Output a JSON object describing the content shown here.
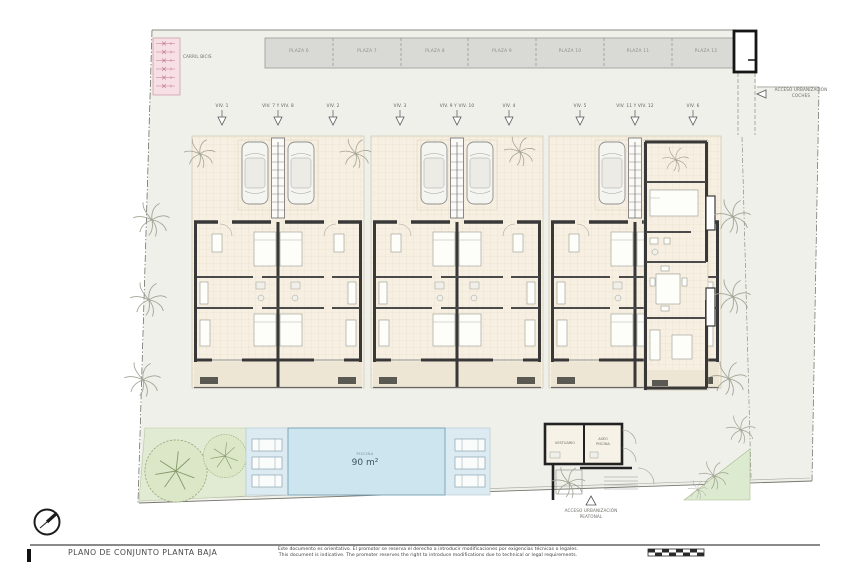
{
  "title_block": {
    "title": "PLANO DE CONJUNTO PLANTA BAJA",
    "disclaimer_es": "Este documento es orientativo. El promotor se reserva el derecho a introducir modificaciones por exigencias técnicas o legales.",
    "disclaimer_en": "This document is indicative. The promoter reserves the right to introduce modifications due to technical or legal requirements."
  },
  "parking": {
    "stalls": [
      "PLAZA 6",
      "PLAZA 7",
      "PLAZA 8",
      "PLAZA 9",
      "PLAZA 10",
      "PLAZA 11",
      "PLAZA 12"
    ]
  },
  "units": {
    "labels": [
      "VIV. 1",
      "VIV. 7 Y VIV. 8",
      "VIV. 2",
      "VIV. 3",
      "VIV. 9 Y VIV. 10",
      "VIV. 4",
      "VIV. 5",
      "VIV. 11 Y VIV. 12",
      "VIV. 6"
    ]
  },
  "site": {
    "bike_lane_label": "CARRIL BICIS",
    "access_cars_line1": "ACCESO URBANIZACIÓN",
    "access_cars_line2": "COCHES",
    "access_ped_line1": "ACCESO URBANIZACIÓN",
    "access_ped_line2": "PEATONAL",
    "pool_label": "PISCINA",
    "pool_area": "90 m²",
    "pool_house_left": "VESTUARIO",
    "pool_house_right_line1": "ASEO",
    "pool_house_right_line2": "PISCINA"
  },
  "colors": {
    "site_fill": "#eff0ea",
    "parking_fill": "#d9dad6",
    "pink_strip": "#f6e0e6",
    "pool_water": "#cde5ef",
    "pool_deck": "#dcebf1",
    "garden_green": "#e1ebd3",
    "wall": "#383838"
  }
}
